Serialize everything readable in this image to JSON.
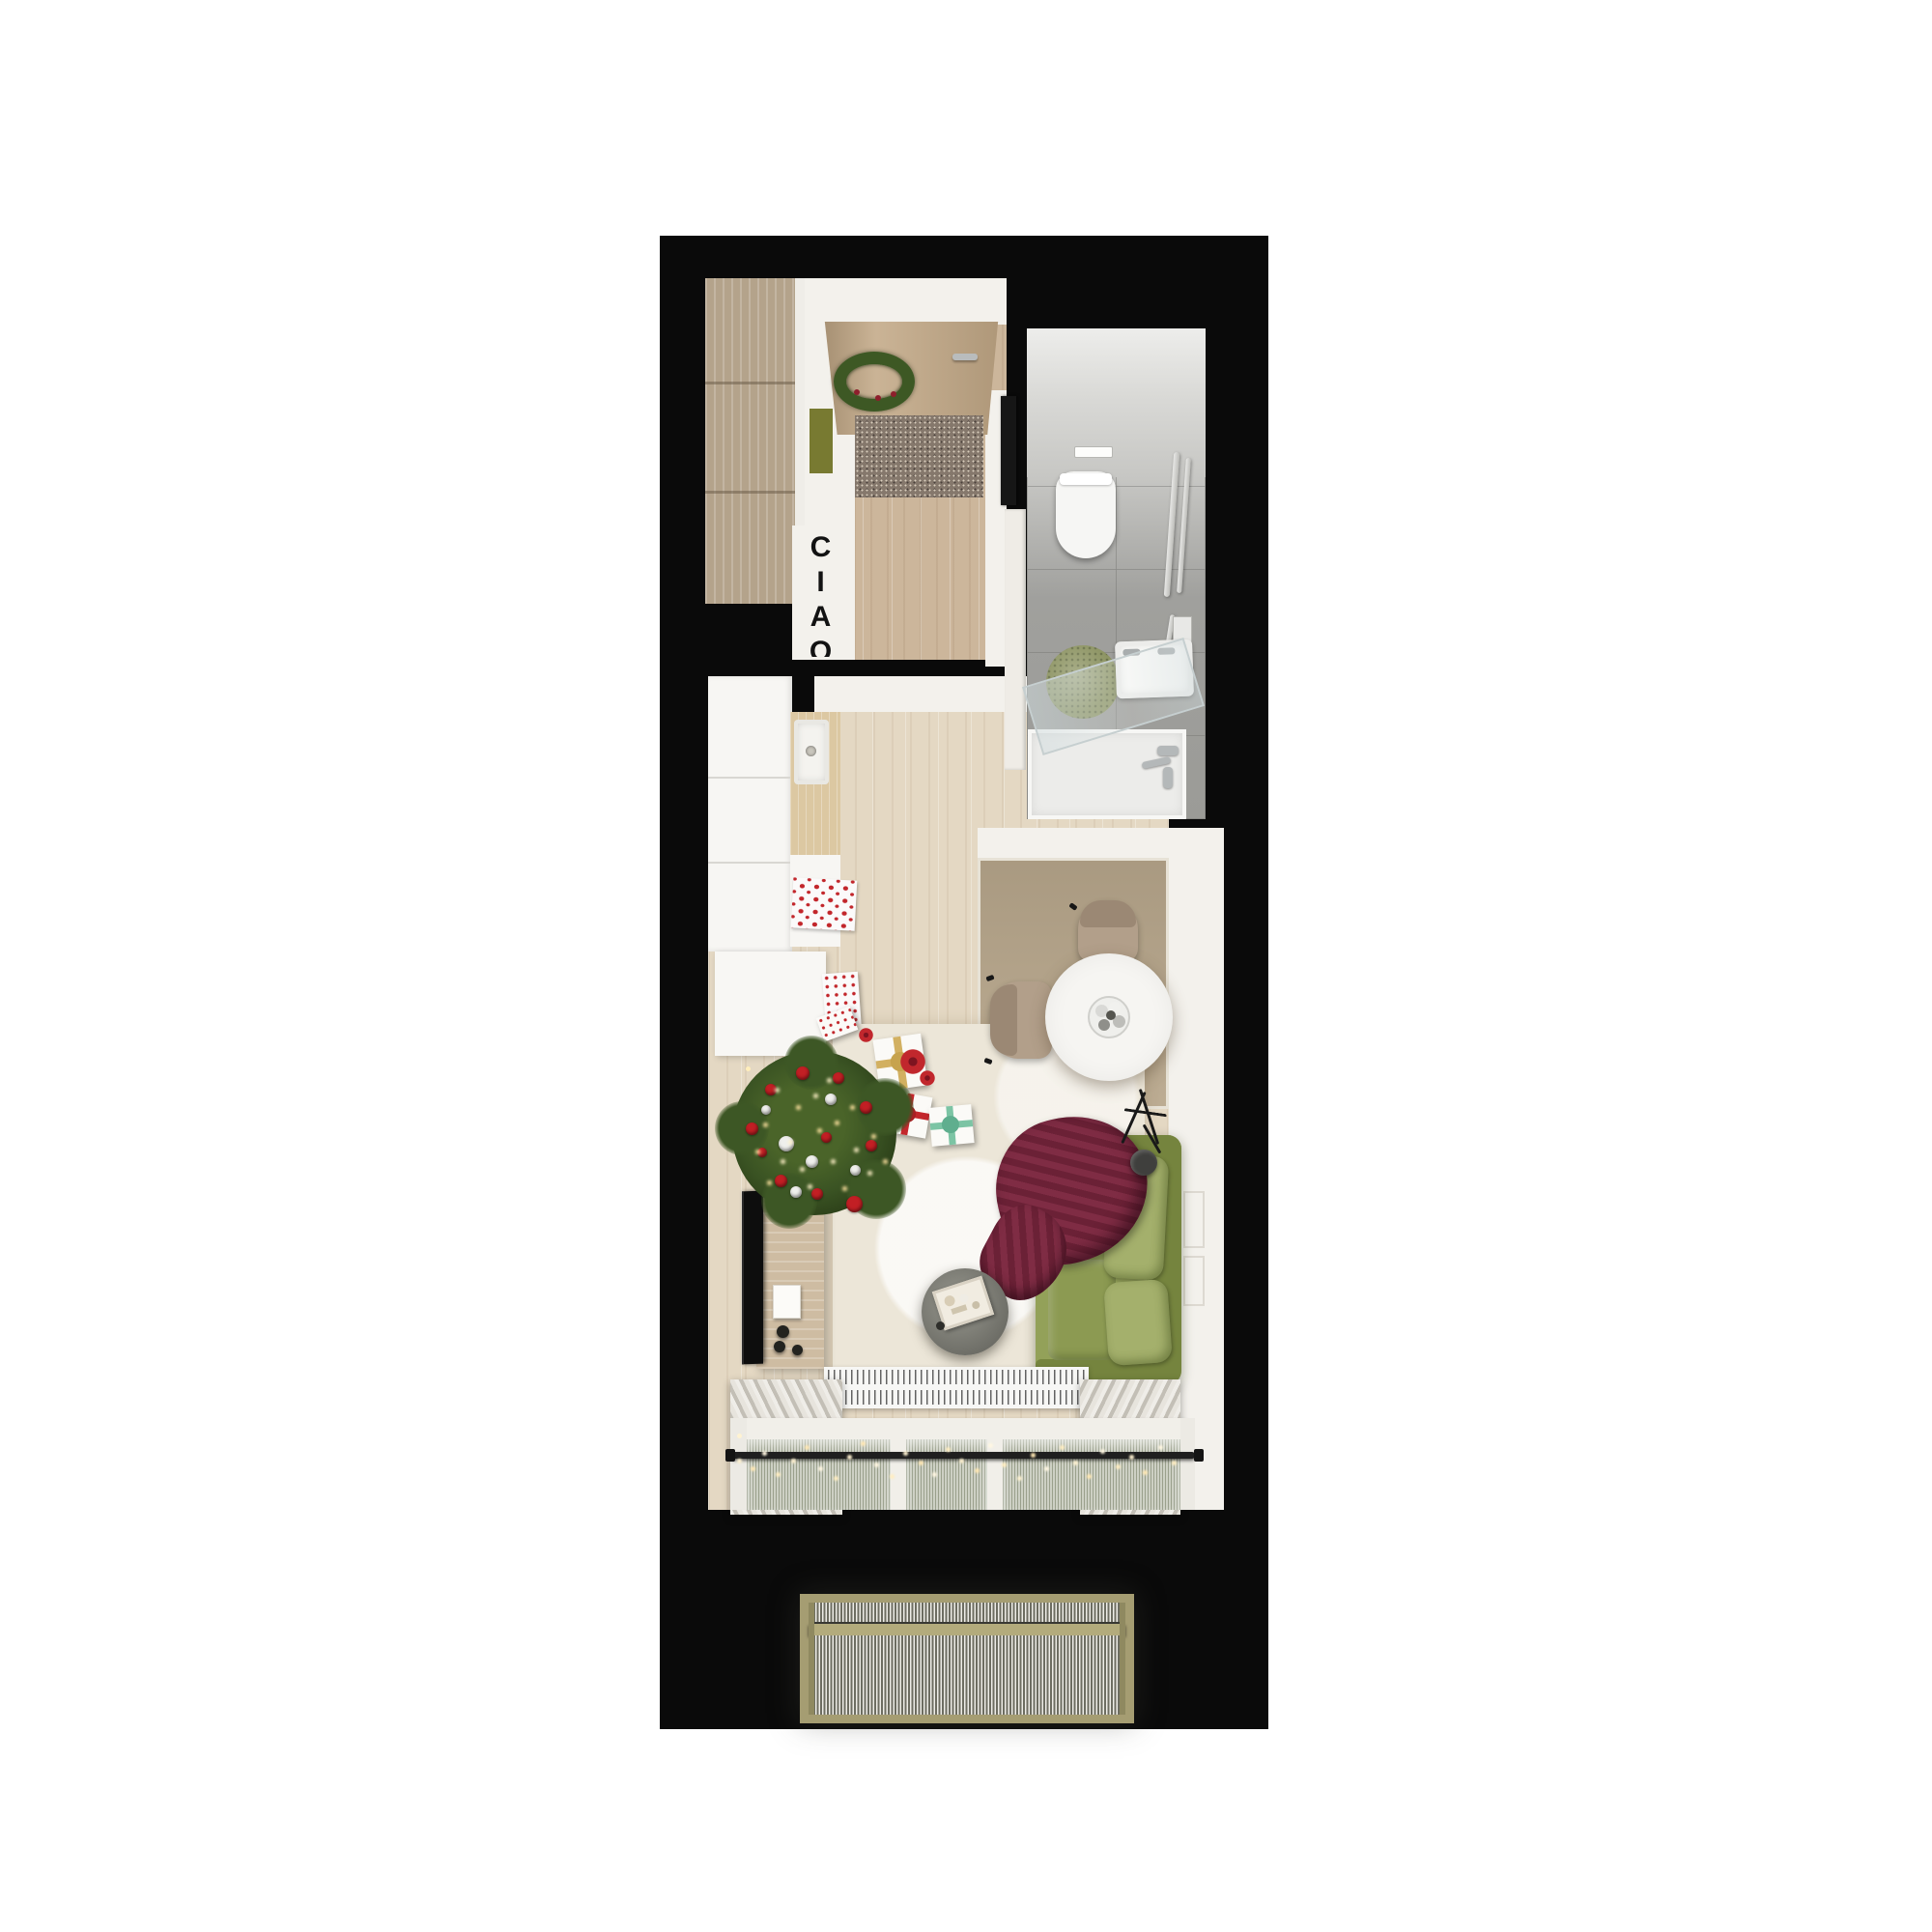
{
  "title": "studio-apartment-floor-plan-top-view",
  "hallway": {
    "ciao_text": "CIAO"
  },
  "colors": {
    "page": "#ffffff",
    "wall": "#0a0a0a",
    "hallFloor": "#ccb69b",
    "white": "#f3f1ec",
    "wardrobe": "#b4a38b",
    "door": "#c3a987",
    "doormat": "#85786c",
    "wreath": "#3d5824",
    "bench": "#787a31",
    "mirror": "#161616",
    "bathWall": "#c7c7c4",
    "bathFloor": "#a0a09d",
    "bathRug": "#8d9463",
    "fixture": "#f6f6f4",
    "kitchen": "#f7f6f3",
    "counter": "#dcc8a2",
    "towelRed": "#c2262b",
    "livingFloor": "#e4d8c3",
    "niche": "#b8a78c",
    "rug": "#ece6d8",
    "chair": "#b29f8a",
    "table": "#f6f5f2",
    "lamp": "#3f3f3d",
    "sofa": "#93a159",
    "sofaDark": "#75843e",
    "sofaLight": "#a4b06c",
    "blanket": "#6e2438",
    "tree": "#3a5323",
    "red": "#c21f24",
    "light": "#ffdf9e",
    "console": "#cebca2",
    "tv": "#0d0d0d",
    "radiator": "#f7f7f5",
    "curtain": "#dcd8d0",
    "rod": "#1f1f1f",
    "balconyFrame": "#a59d72",
    "grateDark": "#6d6d61",
    "grateLight": "#eeede7"
  },
  "rooms": [
    {
      "name": "entry-hall",
      "items": [
        "wardrobe",
        "entrance-door",
        "christmas-wreath",
        "door-handle",
        "doormat",
        "green-bench",
        "wall-mirror",
        "bathroom-door",
        "ciao-lettering"
      ]
    },
    {
      "name": "bathroom",
      "items": [
        "wall-hung-toilet",
        "ceiling-light",
        "towel-rails",
        "mirror-cabinet",
        "washbasin",
        "glass-shower-screen",
        "round-green-rug",
        "shower-mixer",
        "shower-tray"
      ]
    },
    {
      "name": "kitchen",
      "items": [
        "cabinet-run",
        "wood-countertop",
        "kitchen-sink",
        "lower-cabinet",
        "snowflake-towel",
        "patterned-box"
      ]
    },
    {
      "name": "living-room",
      "items": [
        "dining-niche",
        "round-dining-table",
        "ornament-bowl",
        "dining-chair-top",
        "dining-chair-left",
        "tripod-floor-lamp",
        "green-sofa",
        "burgundy-knit-blanket",
        "cream-area-rug",
        "round-coffee-table",
        "serving-tray",
        "tv",
        "tv-console",
        "christmas-tree",
        "gift-box-gold",
        "gift-box-red",
        "gift-box-teal",
        "poinsettia-flowers",
        "radiator",
        "curtains",
        "curtain-rod",
        "string-light-garland",
        "window"
      ]
    },
    {
      "name": "balcony",
      "items": [
        "metal-grate-floor",
        "railing-bar",
        "khaki-frame"
      ]
    }
  ]
}
